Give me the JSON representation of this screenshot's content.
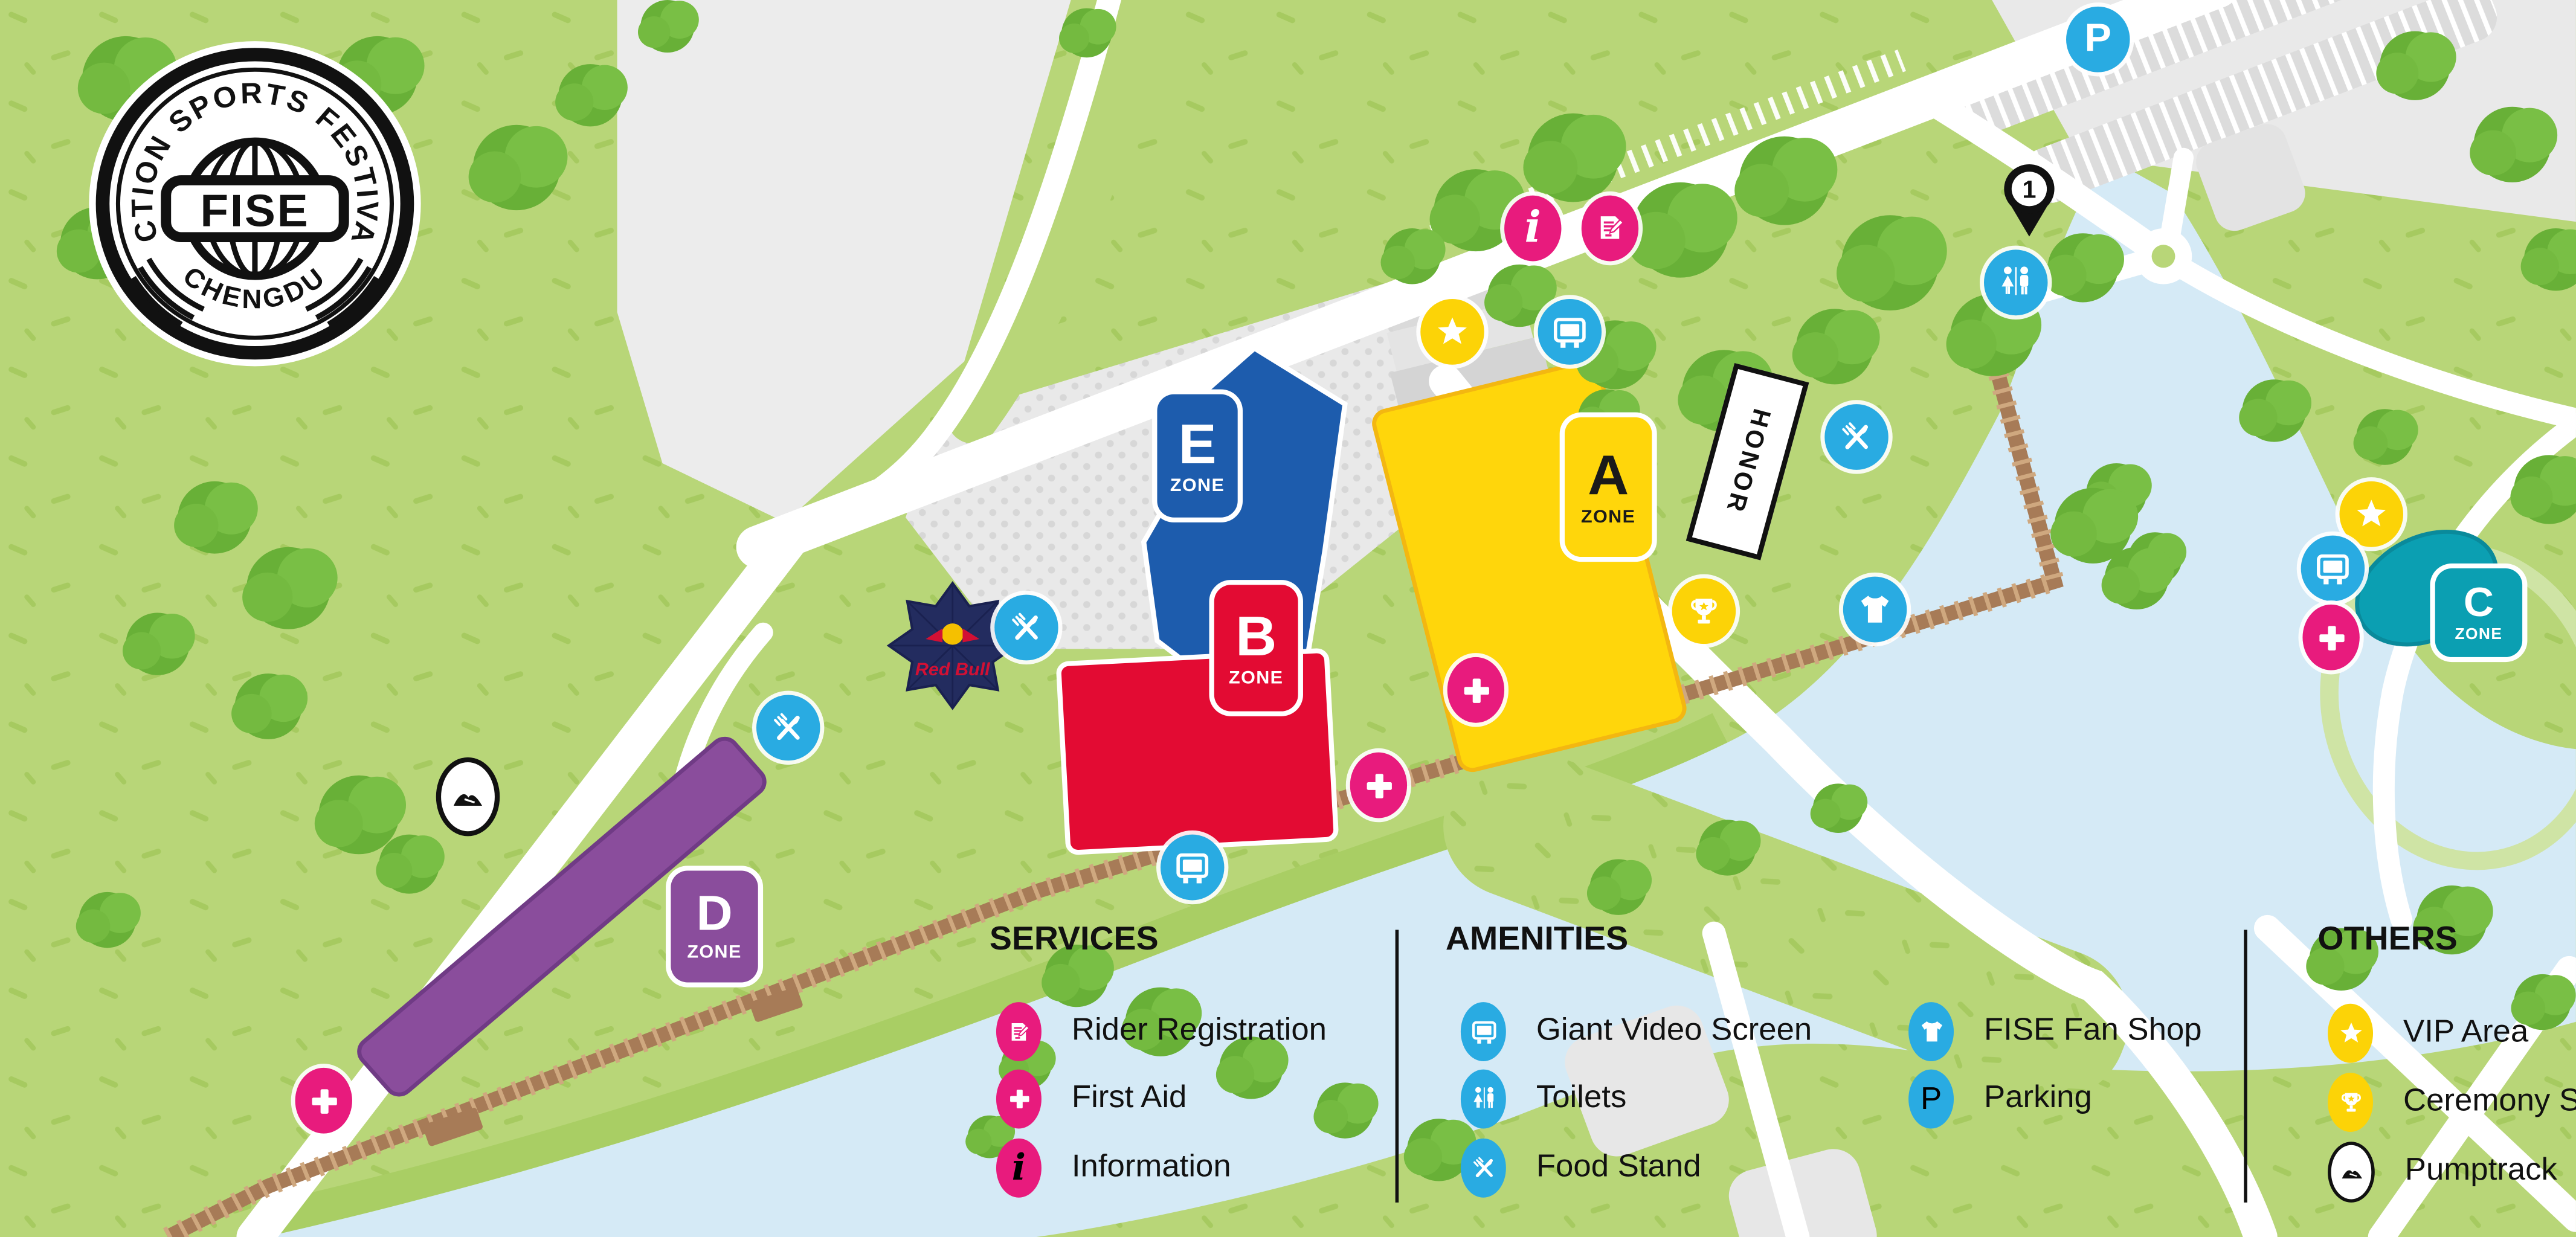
{
  "logo": {
    "arc_top": "ACTION SPORTS FESTIVAL",
    "name": "FISE",
    "arc_bottom": "CHENGDU"
  },
  "map": {
    "zones": [
      {
        "letter": "A",
        "word": "ZONE"
      },
      {
        "letter": "B",
        "word": "ZONE"
      },
      {
        "letter": "C",
        "word": "ZONE"
      },
      {
        "letter": "D",
        "word": "ZONE"
      },
      {
        "letter": "E",
        "word": "ZONE"
      }
    ],
    "honor_sign": "HONOR",
    "red_bull": "Red Bull",
    "marker_1": "1",
    "parking_glyph": "P",
    "info_glyph": "i"
  },
  "legend": {
    "sections": [
      {
        "title": "SERVICES",
        "items": [
          {
            "icon": "rider-registration-icon",
            "label": "Rider Registration"
          },
          {
            "icon": "first-aid-icon",
            "label": "First Aid"
          },
          {
            "icon": "information-icon",
            "label": "Information"
          }
        ]
      },
      {
        "title": "AMENITIES",
        "items": [
          {
            "icon": "giant-video-screen-icon",
            "label": "Giant Video Screen"
          },
          {
            "icon": "toilets-icon",
            "label": "Toilets"
          },
          {
            "icon": "food-stand-icon",
            "label": "Food Stand"
          },
          {
            "icon": "fise-fan-shop-icon",
            "label": "FISE Fan Shop"
          },
          {
            "icon": "parking-icon",
            "label": "Parking"
          }
        ]
      },
      {
        "title": "OTHERS",
        "items": [
          {
            "icon": "vip-area-icon",
            "label": "VIP Area"
          },
          {
            "icon": "ceremony-stage-icon",
            "label": "Ceremony Stage"
          },
          {
            "icon": "pumptrack-icon",
            "label": "Pumptrack"
          }
        ]
      }
    ]
  },
  "colors": {
    "grass": "#b8d678",
    "water": "#d5eaf6",
    "road": "#ffffff",
    "pink": "#e81b7d",
    "blue": "#29abe2",
    "yellow": "#fcd307",
    "zone_a": "#ffd60b",
    "zone_b": "#e30b33",
    "zone_c": "#0b9fb2",
    "zone_d": "#8a4d9c",
    "zone_e": "#1d5cad",
    "rail": "#a77b57",
    "black": "#111111"
  }
}
